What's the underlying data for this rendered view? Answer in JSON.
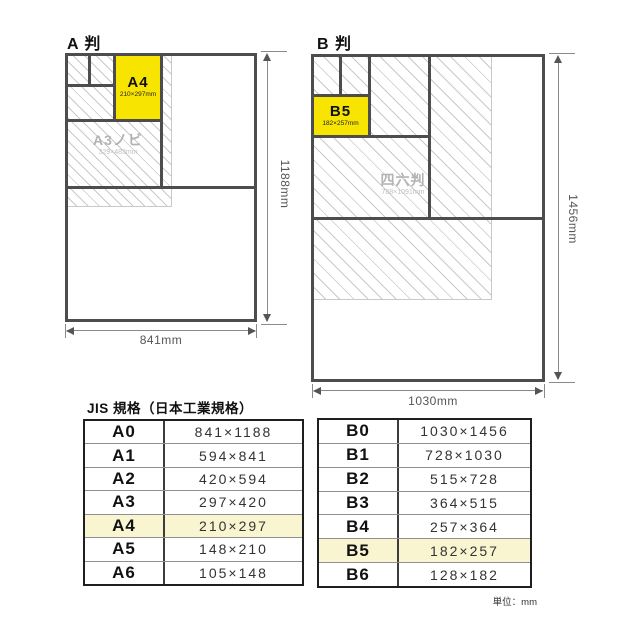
{
  "colors": {
    "accent_yellow": "#f7e400",
    "row_highlight": "#f8f5d0",
    "line_dark": "#4d4d4d",
    "hatch_gray": "#c9c9c9",
    "ghost_text": "#b3b3b3"
  },
  "diagram_a": {
    "title": "A 判",
    "highlight": {
      "label": "A4",
      "size": "210×297mm"
    },
    "ghost": {
      "label": "A3ノビ",
      "size": "329×483mm"
    },
    "width_dim": "841mm",
    "height_dim": "1188mm"
  },
  "diagram_b": {
    "title": "B 判",
    "highlight": {
      "label": "B5",
      "size": "182×257mm"
    },
    "ghost": {
      "label": "四六判",
      "size": "788×1091mm"
    },
    "width_dim": "1030mm",
    "height_dim": "1456mm"
  },
  "table_section": {
    "heading": "JIS 規格（日本工業規格）",
    "unit_note": "単位：mm",
    "a_rows": [
      {
        "label": "A0",
        "size": "841×1188"
      },
      {
        "label": "A1",
        "size": "594×841"
      },
      {
        "label": "A2",
        "size": "420×594"
      },
      {
        "label": "A3",
        "size": "297×420"
      },
      {
        "label": "A4",
        "size": "210×297"
      },
      {
        "label": "A5",
        "size": "148×210"
      },
      {
        "label": "A6",
        "size": "105×148"
      }
    ],
    "b_rows": [
      {
        "label": "B0",
        "size": "1030×1456"
      },
      {
        "label": "B1",
        "size": "728×1030"
      },
      {
        "label": "B2",
        "size": "515×728"
      },
      {
        "label": "B3",
        "size": "364×515"
      },
      {
        "label": "B4",
        "size": "257×364"
      },
      {
        "label": "B5",
        "size": "182×257"
      },
      {
        "label": "B6",
        "size": "128×182"
      }
    ]
  }
}
